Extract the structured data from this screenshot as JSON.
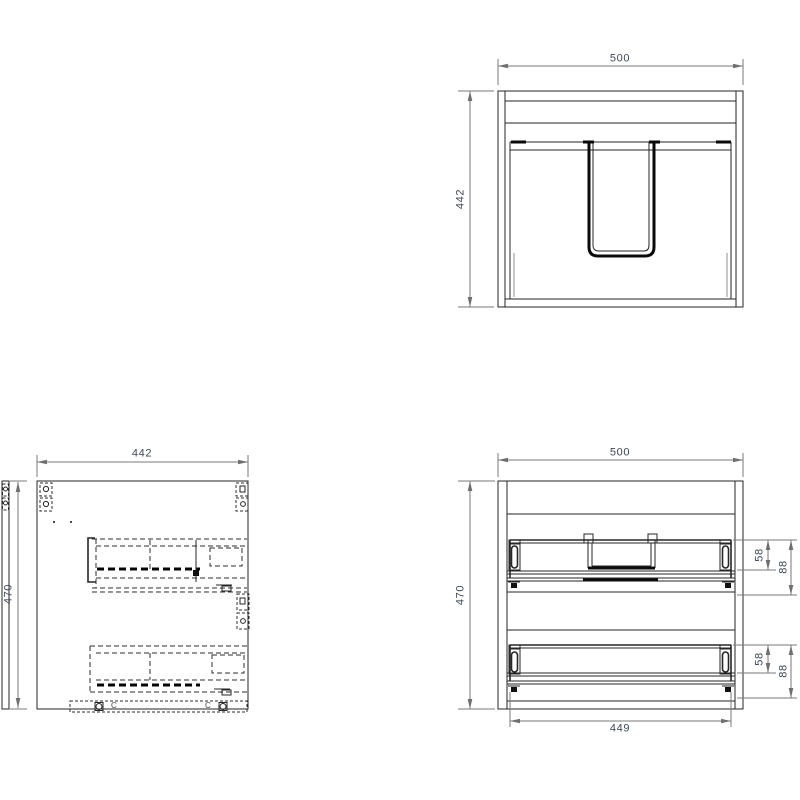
{
  "style": {
    "background": "#ffffff",
    "object_line_color": "#262626",
    "hidden_line_color": "#2e2e2e",
    "dimension_line_color": "#7a7a7a",
    "dim_text_color": "#3e4651"
  },
  "views": {
    "plan": {
      "width_dim": "500",
      "height_dim": "442"
    },
    "side": {
      "width_dim": "442",
      "height_dim": "470",
      "fitting_labels": [
        "C",
        "C"
      ]
    },
    "front": {
      "width_dim": "500",
      "height_dim": "470",
      "drawer_width_dim": "449",
      "upper_drawer": {
        "runner_dim": "58",
        "box_height_dim": "88"
      },
      "lower_drawer": {
        "runner_dim": "58",
        "box_height_dim": "88"
      }
    }
  }
}
